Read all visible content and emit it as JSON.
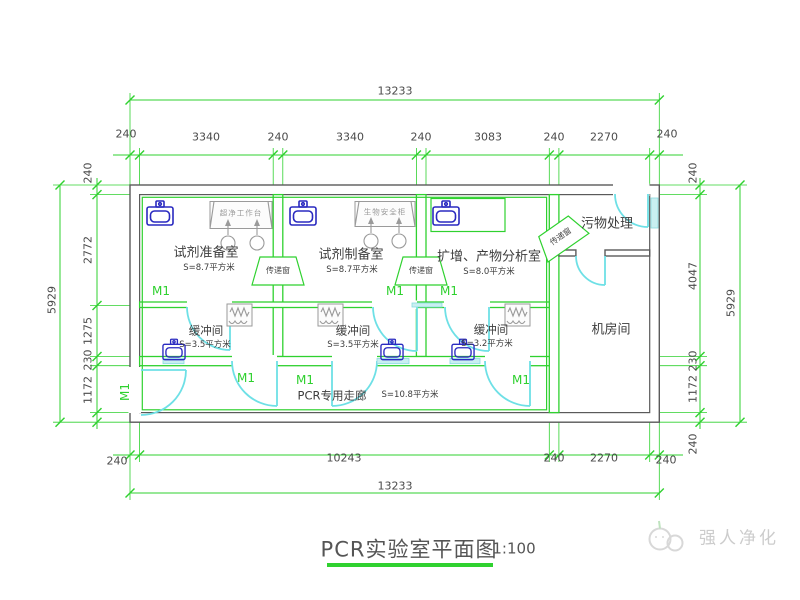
{
  "title": {
    "text": "PCR实验室平面图",
    "scale": "1:100"
  },
  "watermark": {
    "brand": "强人净化"
  },
  "colors": {
    "dimension_green": "#2fd12f",
    "wall_gray": "#5a5a5a",
    "door_cyan": "#6ee0e6",
    "fixture_blue": "#2a2ac0",
    "text_dark": "#4a4a4a",
    "watermark_gray": "#cccccc"
  },
  "dimensions": {
    "top": {
      "overall": "13233",
      "segments": [
        "240",
        "3340",
        "240",
        "3340",
        "240",
        "3083",
        "240",
        "2270",
        "240"
      ]
    },
    "bottom": {
      "overall": "13233",
      "segments": [
        "240",
        "10243",
        "240",
        "2270",
        "240"
      ]
    },
    "left": {
      "overall": "5929",
      "segments": [
        "240",
        "2772",
        "1275",
        "230",
        "1172"
      ]
    },
    "right": {
      "overall": "5929",
      "segments": [
        "240",
        "4047",
        "230",
        "1172",
        "240"
      ]
    }
  },
  "rooms": {
    "reagent_prep": {
      "name": "试剂准备室",
      "area": "S=8.7平方米",
      "equipment": "超净工作台"
    },
    "reagent_make": {
      "name": "试剂制备室",
      "area": "S=8.7平方米",
      "equipment": "生物安全柜"
    },
    "amplification": {
      "name": "扩增、产物分析室",
      "area": "S=8.0平方米"
    },
    "buffer1": {
      "name": "缓冲间",
      "area": "S=3.5平方米"
    },
    "buffer2": {
      "name": "缓冲间",
      "area": "S=3.5平方米"
    },
    "buffer3": {
      "name": "缓冲间",
      "area": "S=3.2平方米"
    },
    "corridor": {
      "name": "PCR专用走廊",
      "area": "S=10.8平方米"
    },
    "waste": {
      "name": "污物处理"
    },
    "machine_room": {
      "name": "机房间"
    }
  },
  "labels": {
    "door": "M1",
    "pass_window": "传递窗"
  }
}
